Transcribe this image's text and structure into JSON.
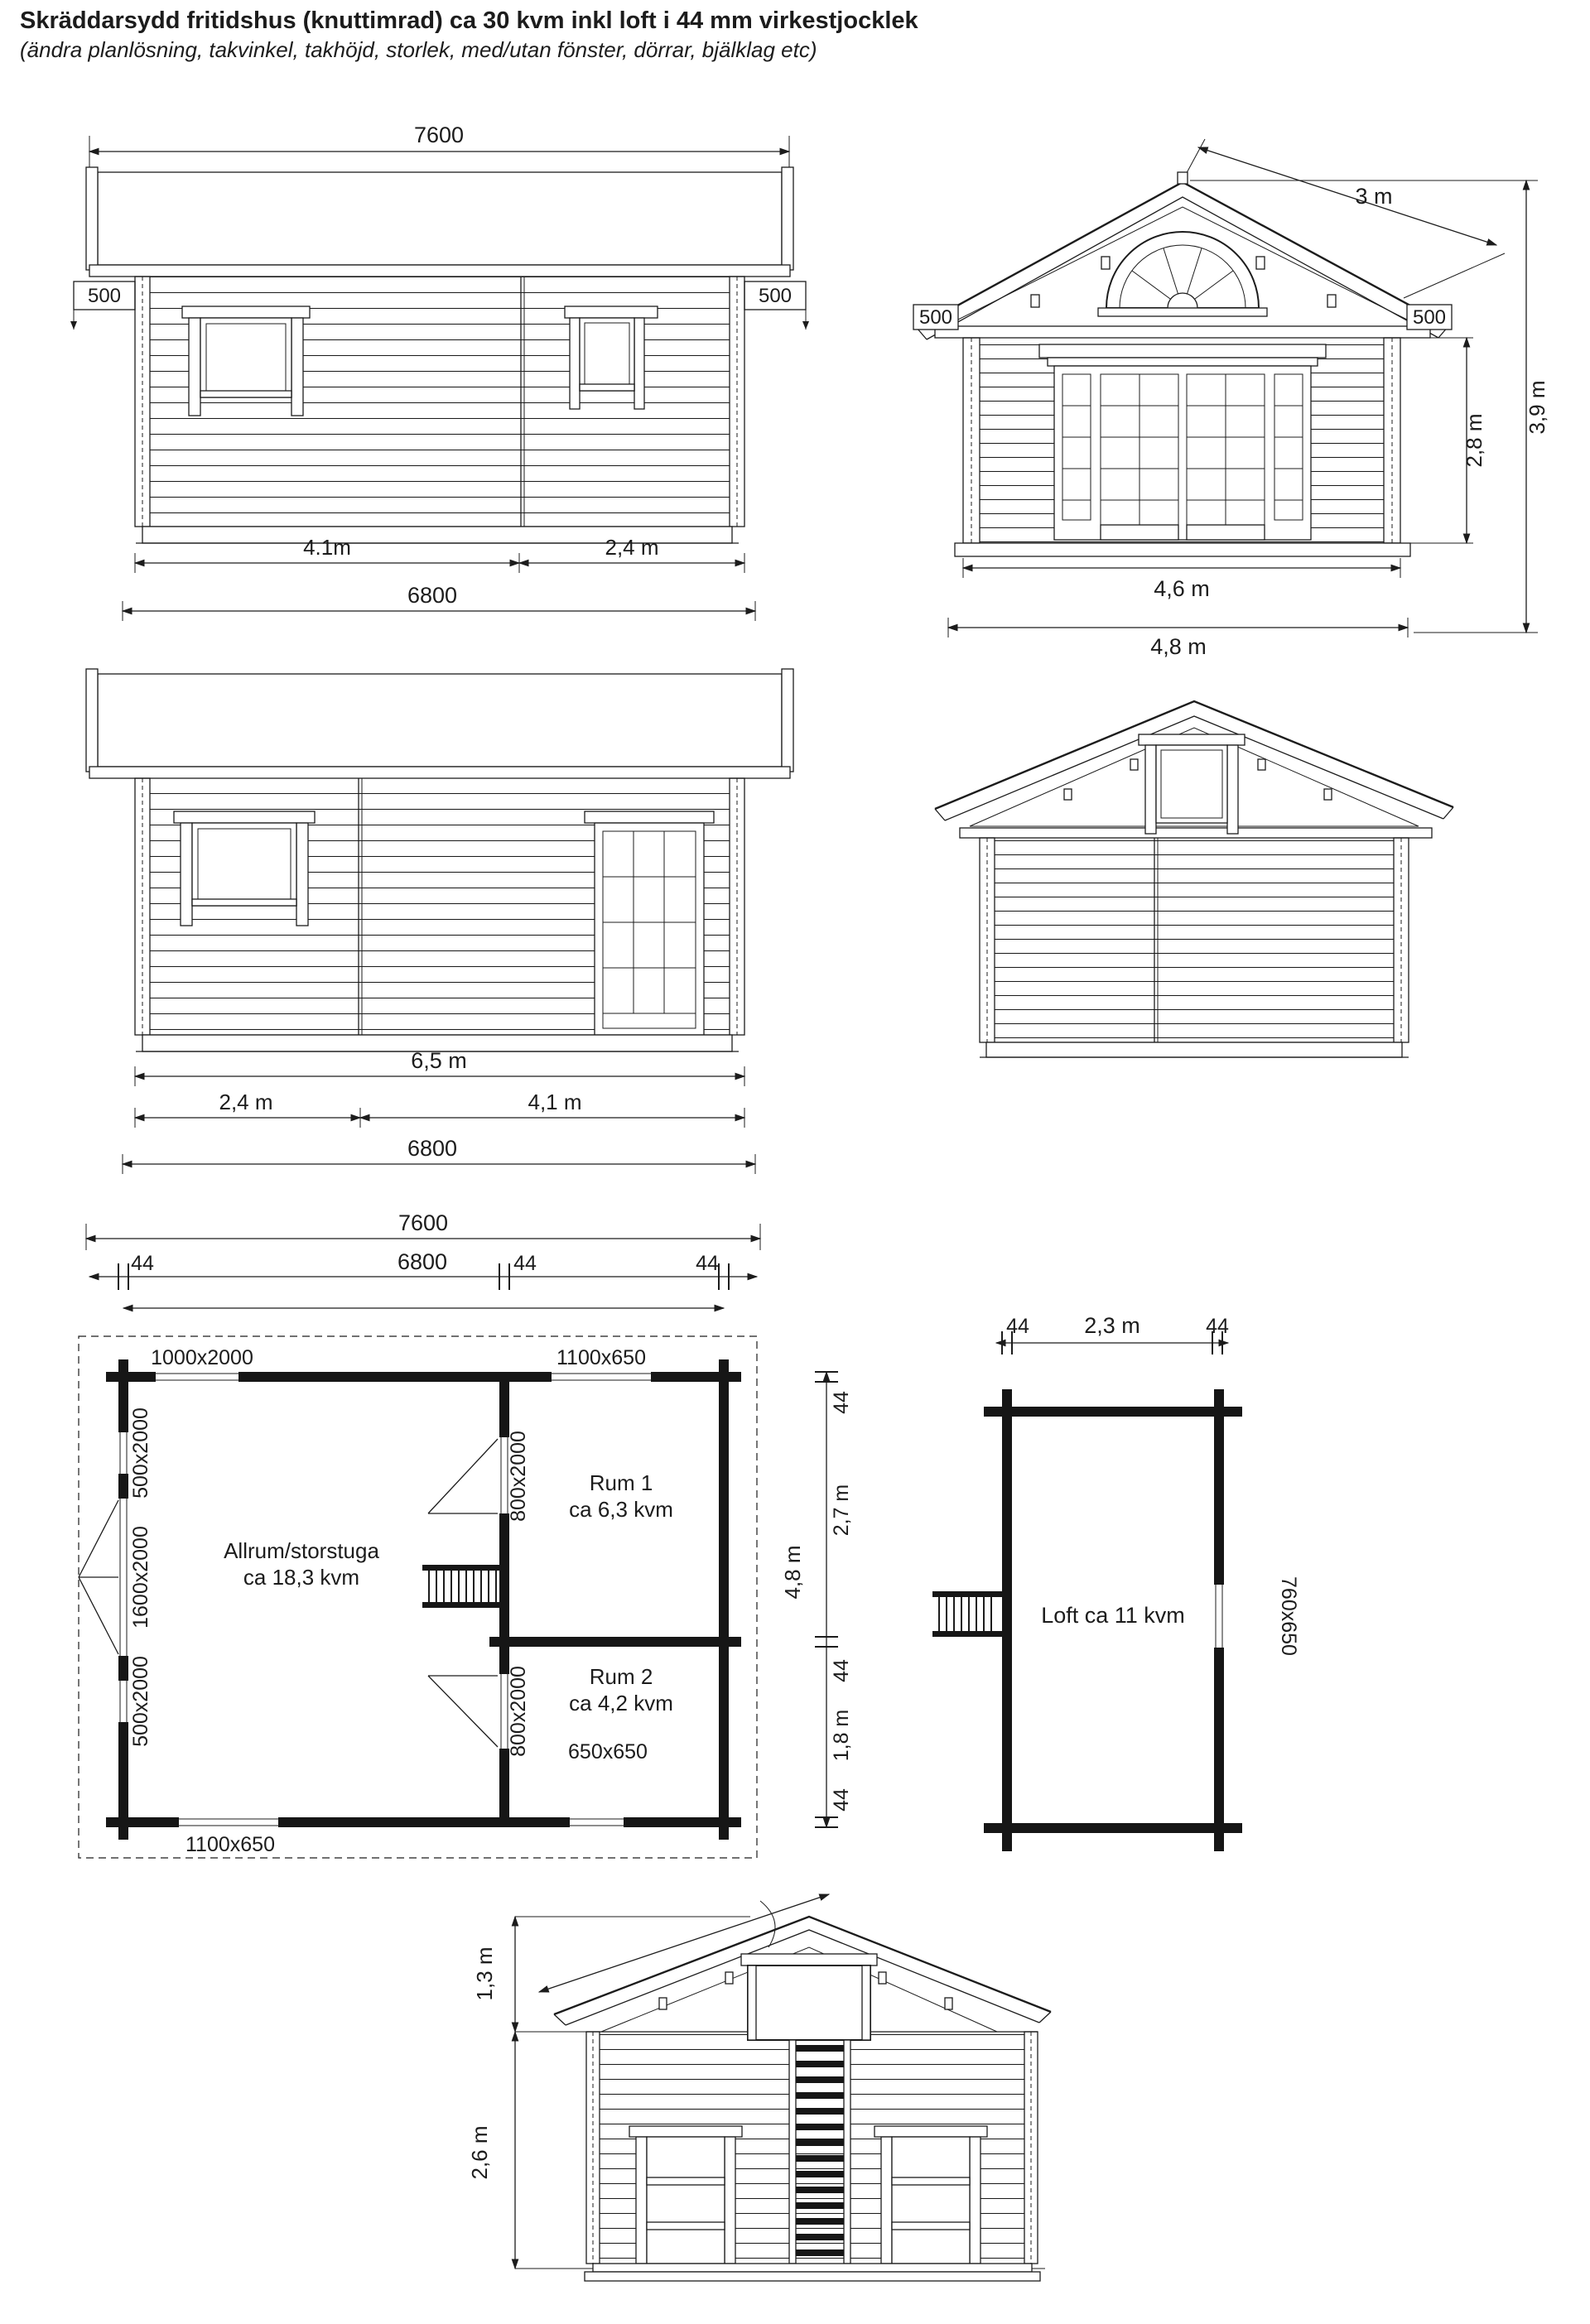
{
  "title": "Skräddarsydd fritidshus (knuttimrad) ca 30 kvm inkl loft i 44 mm virkestjocklek",
  "subtitle": "(ändra planlösning, takvinkel, takhöjd, storlek, med/utan fönster, dörrar, bjälklag etc)",
  "colors": {
    "ink": "#1c1c1c",
    "paper": "#ffffff"
  },
  "elevation_side_a": {
    "roof_width": "7600",
    "overhang_left": "500",
    "overhang_right": "500",
    "span_left": "4.1m",
    "span_right": "2,4 m",
    "wall_length": "6800"
  },
  "elevation_front": {
    "roof_slope": "3 m",
    "overhang_left": "500",
    "overhang_right": "500",
    "wall_height": "2,8 m",
    "total_height": "3,9 m",
    "front_width": "4,6 m",
    "total_width": "4,8 m"
  },
  "elevation_side_b": {
    "wall_top_length": "6,5 m",
    "span_left": "2,4 m",
    "span_right": "4,1 m",
    "wall_length": "6800"
  },
  "floor_plan": {
    "overall_width": "7600",
    "wall_left": "44",
    "inner_length": "6800",
    "wall_mid": "44",
    "wall_right": "44",
    "window_top_left": "1000x2000",
    "window_top_right": "1100x650",
    "window_bottom_left": "1100x650",
    "window_bottom_right": "650x650",
    "left_window_upper": "500x2000",
    "left_door": "1600x2000",
    "left_window_lower": "500x2000",
    "door_rum1": "800x2000",
    "door_rum2": "800x2000",
    "room_main_name": "Allrum/storstuga",
    "room_main_area": "ca 18,3 kvm",
    "room1_name": "Rum 1",
    "room1_area": "ca 6,3 kvm",
    "room2_name": "Rum 2",
    "room2_area": "ca 4,2 kvm",
    "depth_wall_top": "44",
    "depth_rum1": "2,7 m",
    "depth_total": "4,8 m",
    "depth_wall_mid": "44",
    "depth_rum2": "1,8 m",
    "depth_wall_bottom": "44"
  },
  "loft_plan": {
    "wall_left": "44",
    "inner_width": "2,3 m",
    "wall_right": "44",
    "room_label": "Loft ca 11 kvm",
    "window": "760x650"
  },
  "section": {
    "loft_height": "1,3 m",
    "room_height": "2,6 m"
  }
}
